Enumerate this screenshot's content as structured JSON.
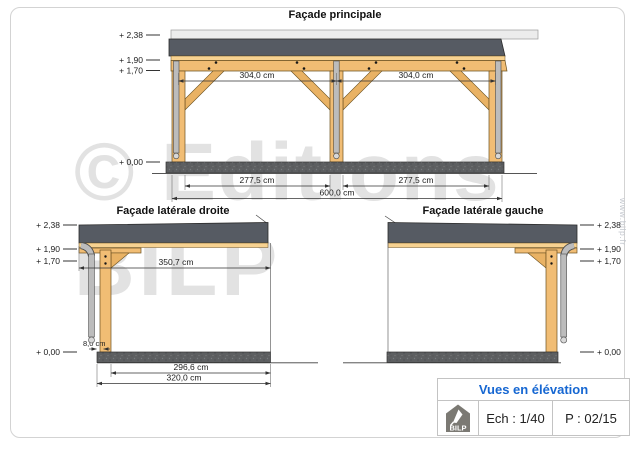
{
  "sheet": {
    "watermark_line1": "© Editions",
    "watermark_line2": "BILP",
    "website_vertical": "www.bilp.fr"
  },
  "views": {
    "principale": {
      "title": "Façade principale",
      "levels": {
        "v238": "+ 2,38",
        "v190": "+ 1,90",
        "v170": "+ 1,70",
        "v000": "+ 0,00"
      },
      "dims": {
        "bay_left": "304,0 cm",
        "bay_right": "304,0 cm",
        "clear_left": "277,5 cm",
        "clear_right": "277,5 cm",
        "total": "600,0 cm"
      }
    },
    "laterale_droite": {
      "title": "Façade latérale droite",
      "levels": {
        "v238": "+ 2,38",
        "v190": "+ 1,90",
        "v170": "+ 1,70",
        "v000": "+ 0,00"
      },
      "dims": {
        "roof_depth": "350,7 cm",
        "post_offset": "8,0 cm",
        "inner": "296,6 cm",
        "total": "320,0 cm"
      }
    },
    "laterale_gauche": {
      "title": "Façade latérale gauche",
      "levels": {
        "v238": "+ 2,38",
        "v190": "+ 1,90",
        "v170": "+ 1,70",
        "v000": "+ 0,00"
      }
    }
  },
  "title_block": {
    "title": "Vues en élévation",
    "scale": "Ech : 1/40",
    "page": "P : 02/15",
    "logo_text": "BILP"
  },
  "colors": {
    "roof_gray": "#565b63",
    "wood_tan": "#f1bd74",
    "slab_gray": "#595b5d",
    "gutter_gray": "#bcbcbc",
    "accent_blue": "#1667d2",
    "watermark_gray": "#e2e2e2"
  }
}
